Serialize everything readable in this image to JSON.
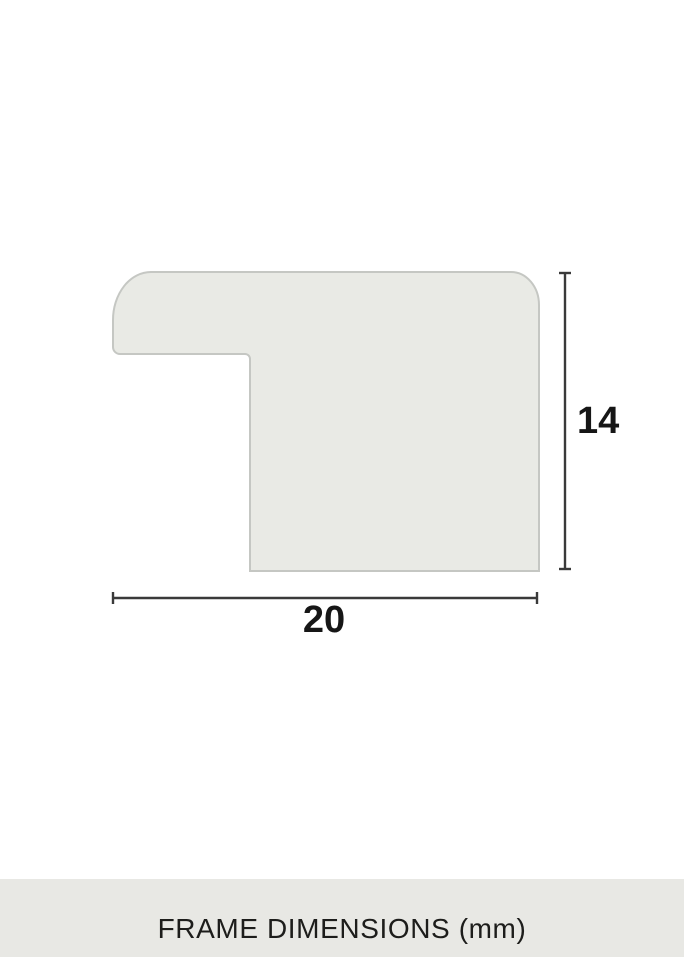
{
  "diagram": {
    "type": "frame-profile-cross-section",
    "height_dimension": {
      "value": "14",
      "orientation": "vertical"
    },
    "width_dimension": {
      "value": "20",
      "orientation": "horizontal"
    },
    "caption": "FRAME DIMENSIONS (mm)",
    "unit": "mm"
  },
  "colors": {
    "profile-fill": "#e9eae5",
    "profile-stroke": "#c5c7c3",
    "dim-line": "#3a3a3a",
    "label-text": "#161616",
    "caption-bg": "#e8e8e4",
    "caption-text": "#1d1d1b",
    "page-bg": "#ffffff"
  }
}
